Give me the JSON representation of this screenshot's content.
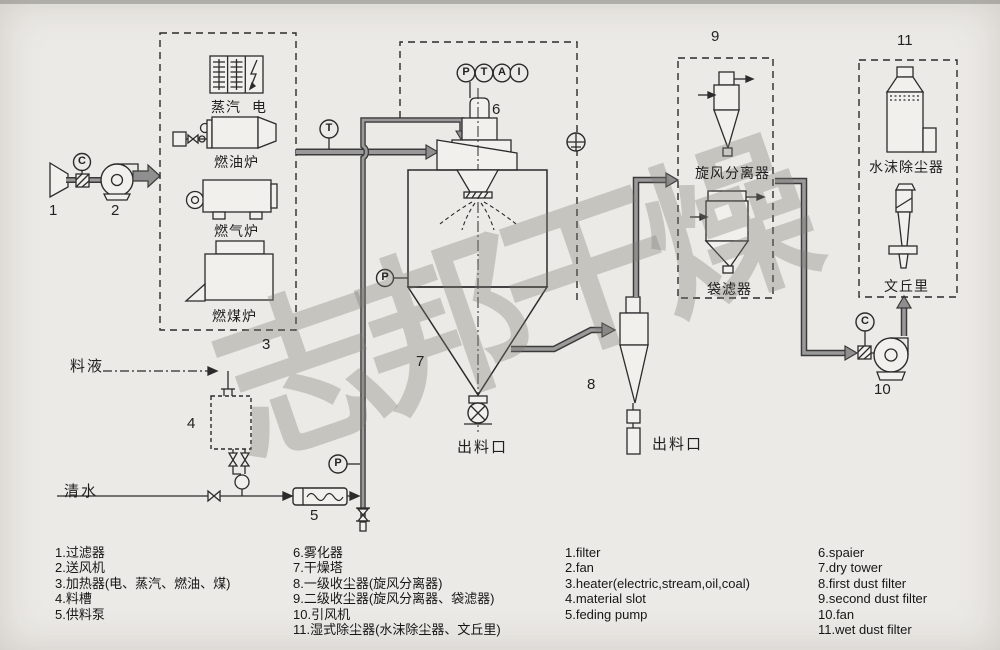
{
  "colors": {
    "background": "#ECEAE6",
    "line": "#2B2B2B",
    "duct_fill": "#9A9A9A",
    "arrow_fill": "#8F8F8F",
    "watermark": "#7D7A76"
  },
  "watermark": {
    "text": "志邦干燥"
  },
  "gauges": {
    "intake_c": "C",
    "duct_t": "T",
    "tower_p": "P",
    "top": [
      "P",
      "T",
      "A",
      "I"
    ],
    "pipe_p": "P",
    "fan_c": "C"
  },
  "numbers": {
    "n1": "1",
    "n2": "2",
    "n3": "3",
    "n4": "4",
    "n5": "5",
    "n6": "6",
    "n7": "7",
    "n8": "8",
    "n9": "9",
    "n10": "10",
    "n11": "11"
  },
  "labels": {
    "steam": "蒸汽",
    "electric": "电",
    "oil_furnace": "燃油炉",
    "gas_furnace": "燃气炉",
    "coal_furnace": "燃煤炉",
    "feed_liquid": "料液",
    "clean_water": "清水",
    "tower_discharge": "出料口",
    "cyclone_discharge": "出料口",
    "cyclone_separator": "旋风分离器",
    "bag_filter": "袋滤器",
    "water_mist_remover": "水沫除尘器",
    "venturi": "文丘里"
  },
  "legend": {
    "zh_col1": [
      "1.过滤器",
      "2.送风机",
      "3.加热器(电、蒸汽、燃油、煤)",
      "4.料槽",
      "5.供料泵"
    ],
    "zh_col2": [
      "6.雾化器",
      "7.干燥塔",
      "8.一级收尘器(旋风分离器)",
      "9.二级收尘器(旋风分离器、袋滤器)",
      "10.引风机",
      "11.湿式除尘器(水沫除尘器、文丘里)"
    ],
    "en_col1": [
      "1.filter",
      "2.fan",
      "3.heater(electric,stream,oil,coal)",
      "4.material slot",
      "5.feding pump"
    ],
    "en_col2": [
      "6.spaier",
      "7.dry tower",
      "8.first dust filter",
      "9.second dust filter",
      "10.fan",
      "11.wet dust filter"
    ]
  }
}
